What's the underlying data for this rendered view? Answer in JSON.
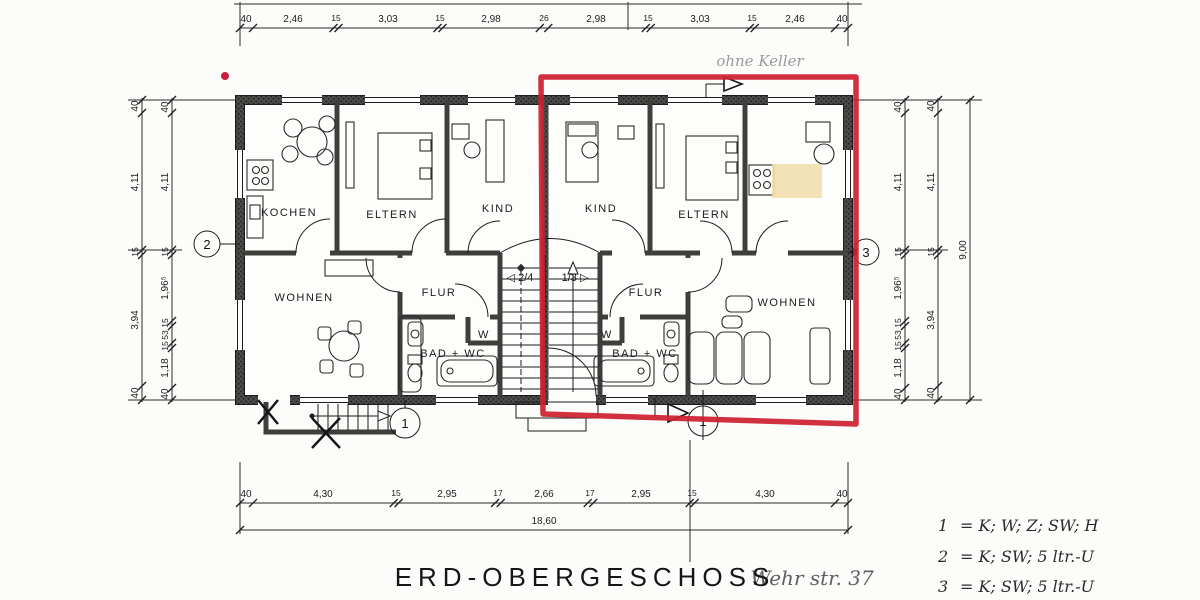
{
  "drawing": {
    "title": "ERD-OBERGESCHOSS",
    "street_note": "Wehr str. 37",
    "cellar_note": "ohne Keller"
  },
  "legend": {
    "items": [
      {
        "key": "1",
        "value": "= K; W; Z; SW; H"
      },
      {
        "key": "2",
        "value": "= K; SW; 5 ltr.-U"
      },
      {
        "key": "3",
        "value": "= K; SW; 5 ltr.-U"
      }
    ]
  },
  "rooms": {
    "left_kitchen": "KOCHEN",
    "left_parents": "ELTERN",
    "left_child": "KIND",
    "left_living": "WOHNEN",
    "left_hall": "FLUR",
    "left_bath": "BAD + WC",
    "left_closet": "W",
    "right_child": "KIND",
    "right_parents": "ELTERN",
    "right_living": "WOHNEN",
    "right_hall": "FLUR",
    "right_bath": "BAD + WC",
    "right_closet": "W"
  },
  "stairs": {
    "left_marker": "◁ 2/4",
    "right_marker": "1/3 ▷"
  },
  "unit_markers": {
    "left_side": "2",
    "right_side": "3",
    "left_entry": "1",
    "right_entry": "1"
  },
  "dimensions": {
    "top": [
      "40",
      "2,46",
      "15",
      "3,03",
      "15",
      "2,98",
      "26",
      "2,98",
      "15",
      "3,03",
      "15",
      "2,46",
      "40"
    ],
    "bottom": [
      "40",
      "4,30",
      "15",
      "2,95",
      "17",
      "2,66",
      "17",
      "2,95",
      "15",
      "4,30",
      "40"
    ],
    "bottom_total": "18,60",
    "left_outer": [
      "40",
      "4,11",
      "15",
      "3,94",
      "40"
    ],
    "left_inner": [
      "40",
      "4,11",
      "15",
      "1,96⁵",
      "15",
      "53",
      "15",
      "1,18",
      "40"
    ],
    "right_inner": [
      "40",
      "4,11",
      "15",
      "1,96⁵",
      "15",
      "53",
      "15",
      "1,18",
      "40"
    ],
    "right_middle": [
      "40",
      "4,11",
      "15",
      "3,94",
      "40"
    ],
    "right_total": "9,00"
  },
  "colors": {
    "highlight_red": "#ce2130",
    "marker_beige": "#f1dfae",
    "pencil": "#9a9a9a"
  }
}
